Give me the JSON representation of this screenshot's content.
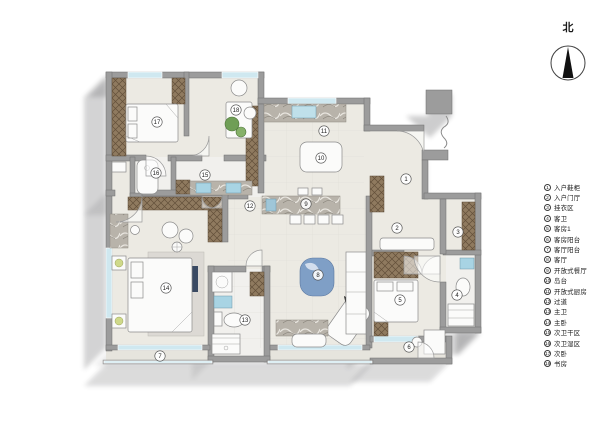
{
  "compass": {
    "label": "北"
  },
  "legend": {
    "items": [
      {
        "num": "1",
        "label": "入户鞋柜"
      },
      {
        "num": "2",
        "label": "入户门厅"
      },
      {
        "num": "3",
        "label": "挂衣区"
      },
      {
        "num": "4",
        "label": "客卫"
      },
      {
        "num": "5",
        "label": "客房1"
      },
      {
        "num": "6",
        "label": "客房阳台"
      },
      {
        "num": "7",
        "label": "客厅阳台"
      },
      {
        "num": "8",
        "label": "客厅"
      },
      {
        "num": "9",
        "label": "开放式餐厅"
      },
      {
        "num": "10",
        "label": "岛台"
      },
      {
        "num": "11",
        "label": "开放式厨房"
      },
      {
        "num": "12",
        "label": "过道"
      },
      {
        "num": "13",
        "label": "主卫"
      },
      {
        "num": "14",
        "label": "主卧"
      },
      {
        "num": "15",
        "label": "次卫干区"
      },
      {
        "num": "16",
        "label": "次卫湿区"
      },
      {
        "num": "17",
        "label": "次卧"
      },
      {
        "num": "18",
        "label": "书房"
      }
    ]
  },
  "plan_markers": [
    {
      "n": "1",
      "x": 406,
      "y": 179
    },
    {
      "n": "2",
      "x": 397,
      "y": 228
    },
    {
      "n": "3",
      "x": 458,
      "y": 232
    },
    {
      "n": "4",
      "x": 457,
      "y": 295
    },
    {
      "n": "5",
      "x": 400,
      "y": 300
    },
    {
      "n": "6",
      "x": 409,
      "y": 347
    },
    {
      "n": "7",
      "x": 160,
      "y": 356
    },
    {
      "n": "8",
      "x": 318,
      "y": 275
    },
    {
      "n": "9",
      "x": 306,
      "y": 204
    },
    {
      "n": "10",
      "x": 321,
      "y": 158
    },
    {
      "n": "11",
      "x": 324,
      "y": 131
    },
    {
      "n": "12",
      "x": 250,
      "y": 206
    },
    {
      "n": "13",
      "x": 245,
      "y": 320
    },
    {
      "n": "14",
      "x": 166,
      "y": 288
    },
    {
      "n": "15",
      "x": 205,
      "y": 175
    },
    {
      "n": "16",
      "x": 156,
      "y": 173
    },
    {
      "n": "17",
      "x": 157,
      "y": 122
    },
    {
      "n": "18",
      "x": 236,
      "y": 110
    }
  ],
  "colors": {
    "wall": "#9c9c9c",
    "floor": "#eceae3",
    "cabinet": "#8f7a5f",
    "window": "#cfe8f0",
    "accent_orange": "#c8602f",
    "accent_blue": "#7f9fc6",
    "sink_blue": "#a8d4e4",
    "plant_green": "#6f9e56"
  }
}
